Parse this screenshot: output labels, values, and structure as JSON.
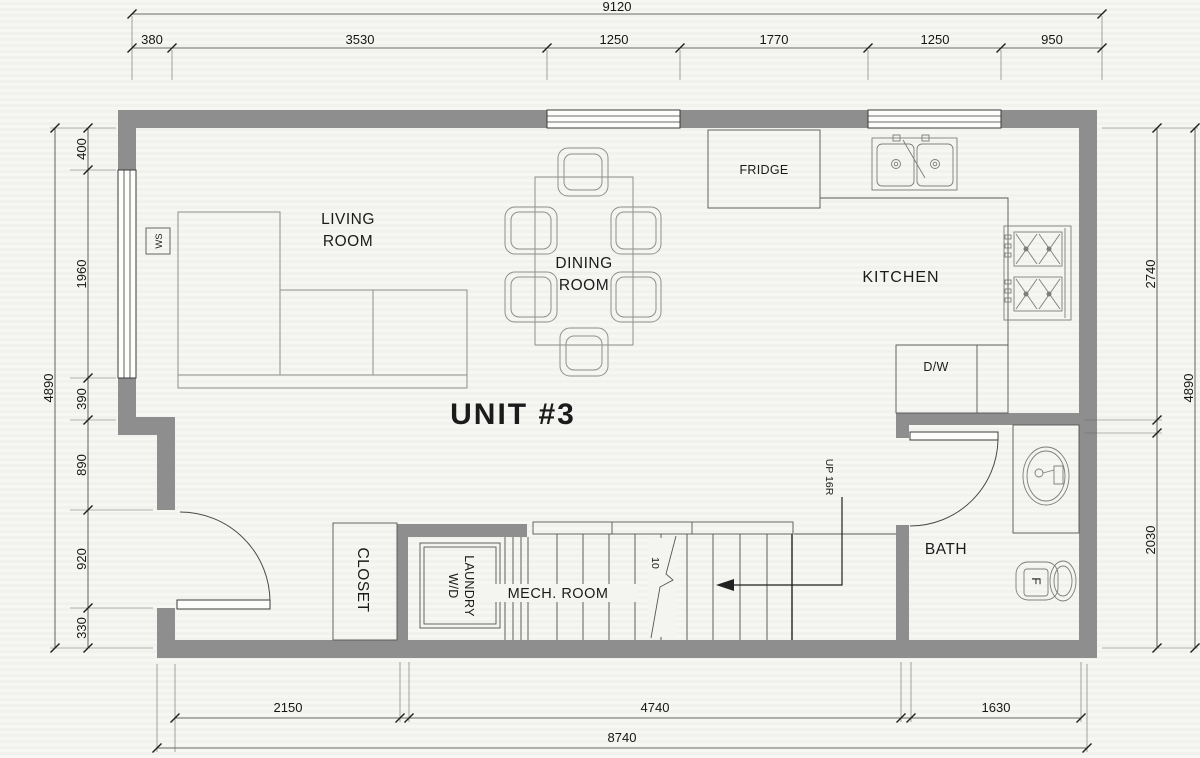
{
  "unit_label": "UNIT #3",
  "rooms": {
    "living": {
      "line1": "LIVING",
      "line2": "ROOM"
    },
    "dining": {
      "line1": "DINING",
      "line2": "ROOM"
    },
    "kitchen": "KITCHEN",
    "bath": "BATH",
    "mech": "MECH. ROOM",
    "closet": "CLOSET",
    "laundry": {
      "line1": "W/D",
      "line2": "LAUNDRY"
    }
  },
  "fixtures": {
    "fridge": "FRIDGE",
    "dishwasher": "D/W",
    "wall_switch": "WS",
    "toilet_mark": "F"
  },
  "stairs": {
    "up_label": "UP 16R",
    "tread_note": "10"
  },
  "dimensions": {
    "top": {
      "overall": "9120",
      "segments": [
        "380",
        "3530",
        "1250",
        "1770",
        "1250",
        "950"
      ]
    },
    "left": {
      "overall": "4890",
      "segments": [
        "400",
        "1960",
        "390",
        "890",
        "920",
        "330"
      ]
    },
    "right": {
      "overall": "4890",
      "segments": [
        "2740",
        "2030"
      ]
    },
    "bottom": {
      "overall": "8740",
      "segments": [
        "2150",
        "4740",
        "1630"
      ]
    }
  },
  "colors": {
    "wall": "#8e8e8e",
    "line": "#4a4a4a",
    "furniture": "#8f8f8f",
    "text": "#1b1b1b",
    "background": "#f4f4f1"
  }
}
